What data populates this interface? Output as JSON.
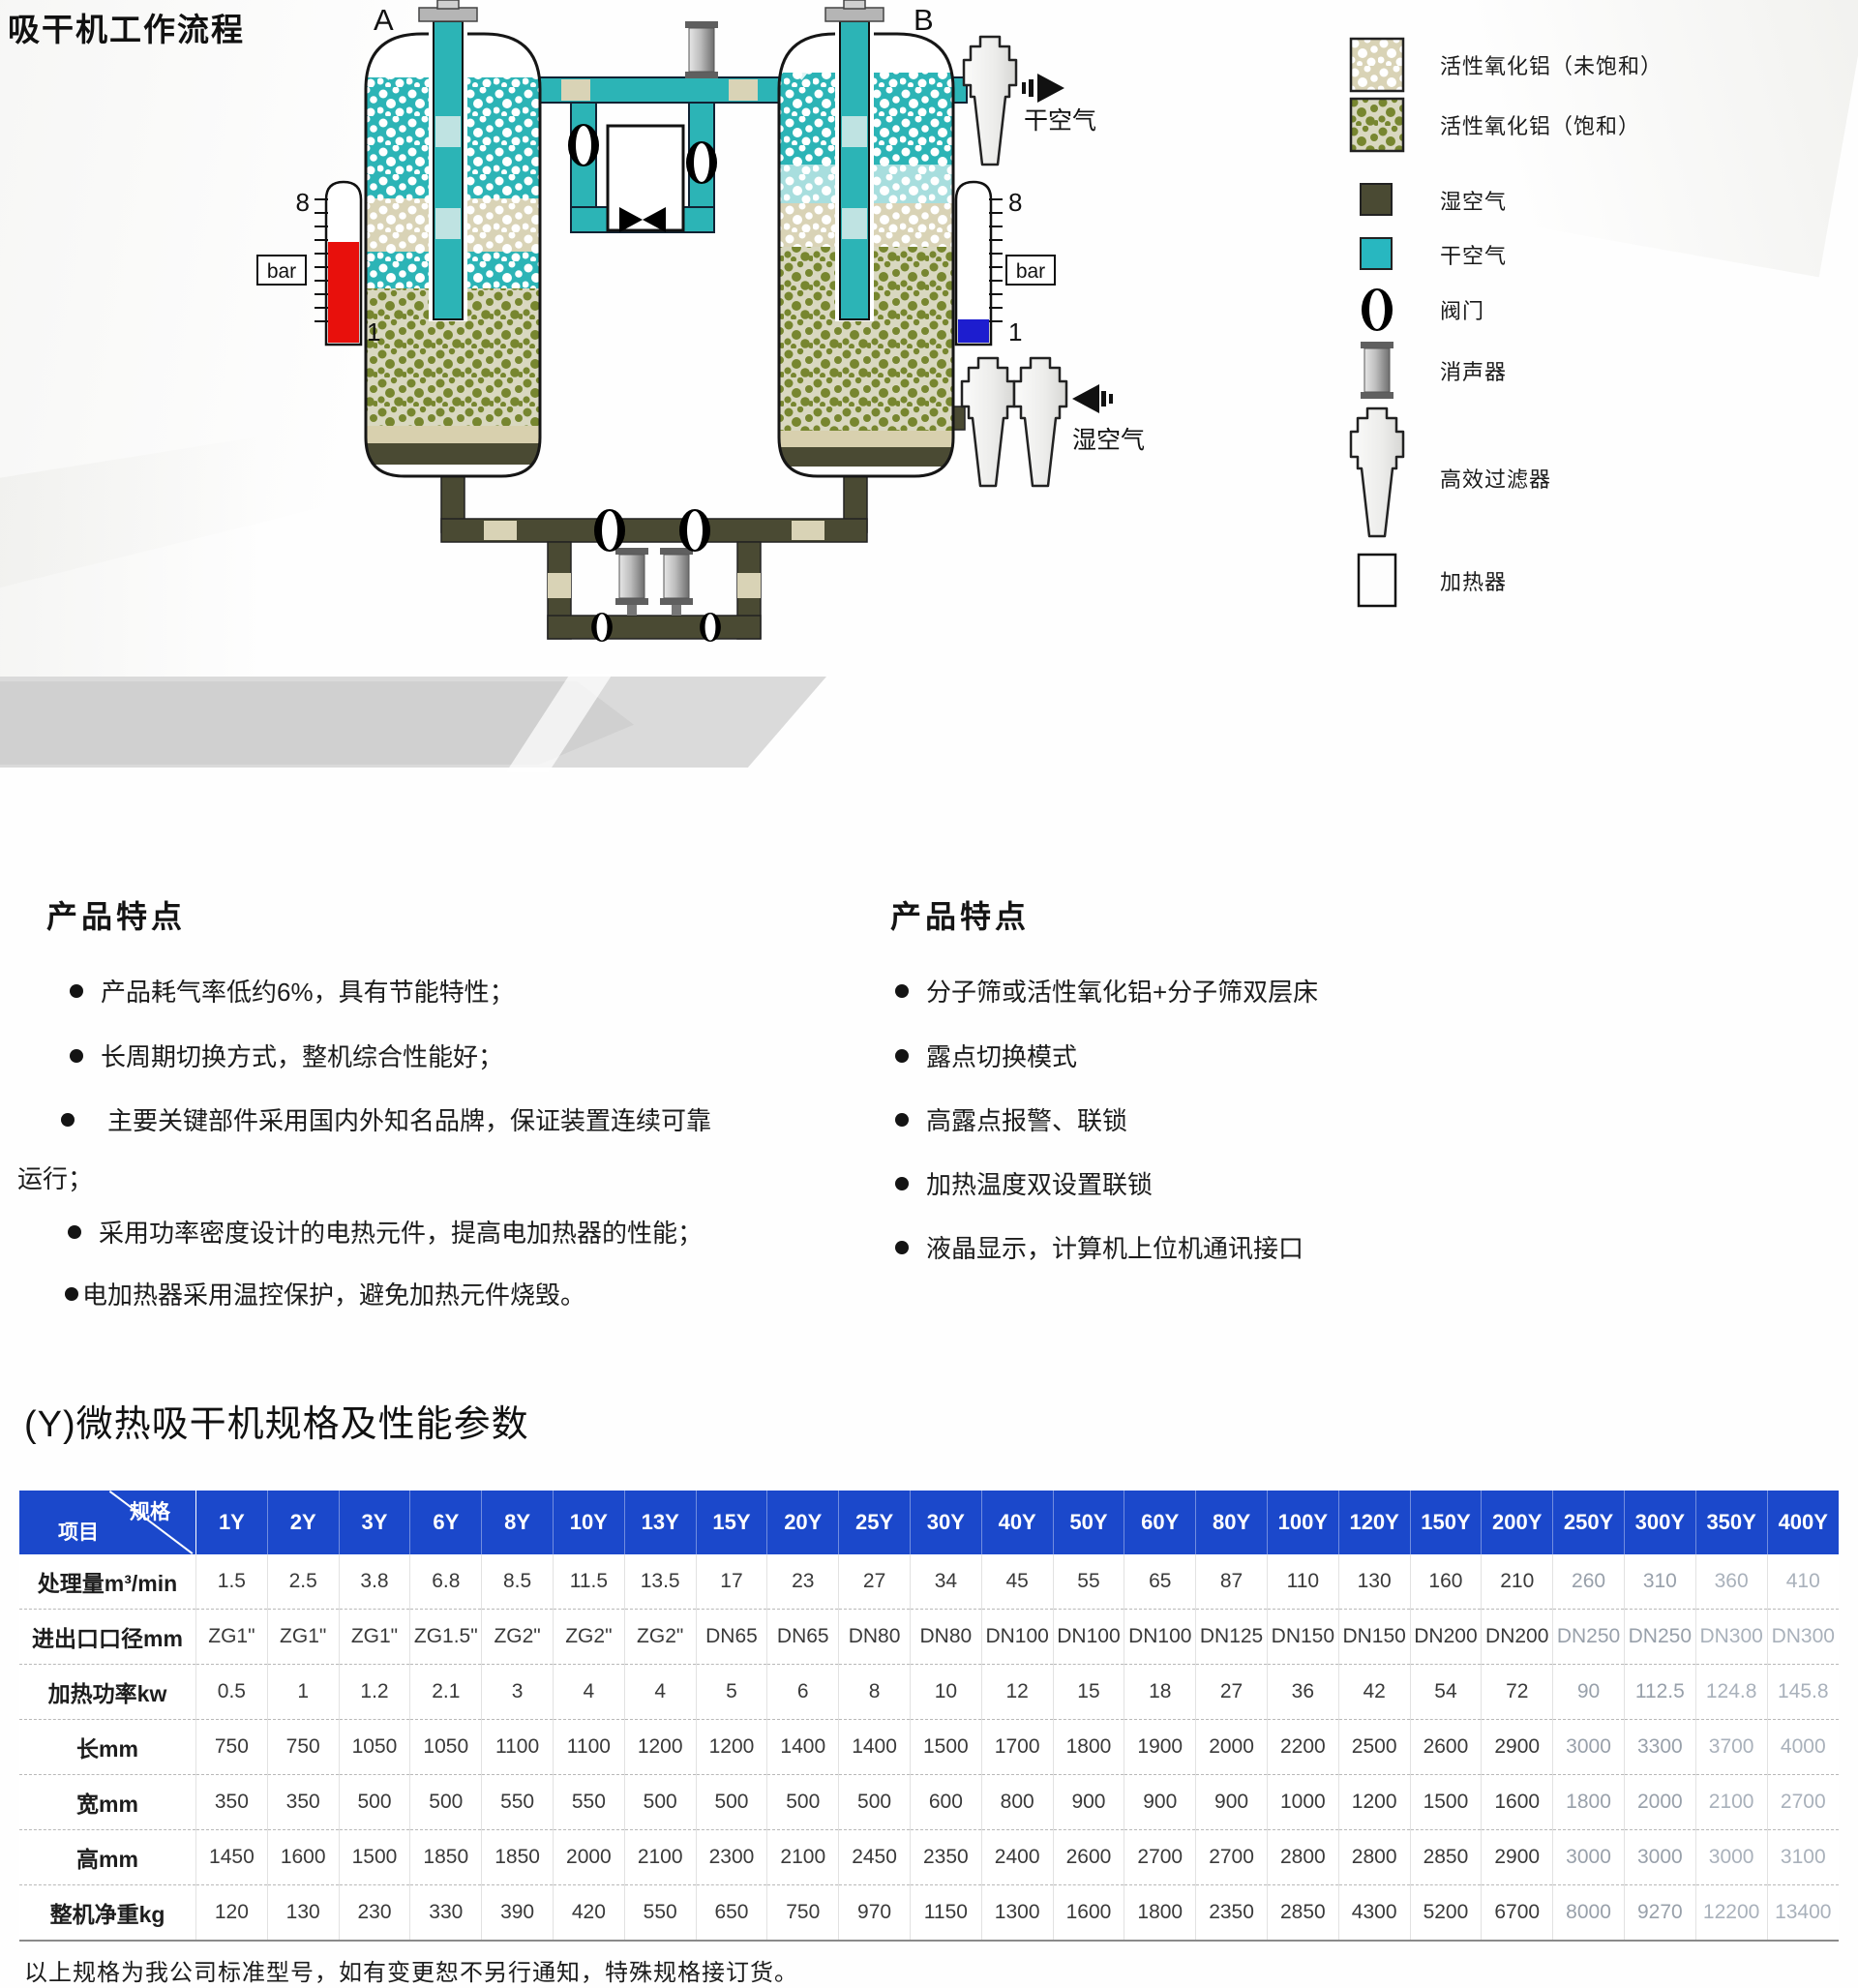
{
  "header": {
    "title": "吸干机工作流程"
  },
  "diagram": {
    "tower_a": "A",
    "tower_b": "B",
    "gauge_left": {
      "top": "8",
      "bottom": "1",
      "unit": "bar"
    },
    "gauge_right": {
      "top": "8",
      "bottom": "1",
      "unit": "bar"
    },
    "dry_air_label": "干空气",
    "wet_air_label": "湿空气"
  },
  "legend": {
    "items": [
      {
        "label": "活性氧化铝（未饱和）"
      },
      {
        "label": "活性氧化铝（饱和）"
      },
      {
        "label": "湿空气"
      },
      {
        "label": "干空气"
      },
      {
        "label": "阀门"
      },
      {
        "label": "消声器"
      },
      {
        "label": "高效过滤器"
      },
      {
        "label": "加热器"
      }
    ]
  },
  "features_left": {
    "heading": "产品特点",
    "items": [
      {
        "text": "产品耗气率低约6%，具有节能特性；"
      },
      {
        "text": "长周期切换方式，整机综合性能好；"
      },
      {
        "text": "主要关键部件采用国内外知名品牌，保证装置连续可靠"
      },
      {
        "text": "运行；"
      },
      {
        "text": "采用功率密度设计的电热元件，提高电加热器的性能；"
      },
      {
        "text": "电加热器采用温控保护，避免加热元件烧毁。"
      }
    ]
  },
  "features_right": {
    "heading": "产品特点",
    "items": [
      {
        "text": "分子筛或活性氧化铝+分子筛双层床"
      },
      {
        "text": "露点切换模式"
      },
      {
        "text": "高露点报警、联锁"
      },
      {
        "text": "加热温度双设置联锁"
      },
      {
        "text": "液晶显示，计算机上位机通讯接口"
      }
    ]
  },
  "spec_section": {
    "title": "(Y)微热吸干机规格及性能参数"
  },
  "table": {
    "corner_top": "规格",
    "corner_bottom": "项目",
    "columns": [
      "1Y",
      "2Y",
      "3Y",
      "6Y",
      "8Y",
      "10Y",
      "13Y",
      "15Y",
      "20Y",
      "25Y",
      "30Y",
      "40Y",
      "50Y",
      "60Y",
      "80Y",
      "100Y",
      "120Y",
      "150Y",
      "200Y",
      "250Y",
      "300Y",
      "350Y",
      "400Y"
    ],
    "rows": [
      {
        "label": "处理量m³/min",
        "values": [
          "1.5",
          "2.5",
          "3.8",
          "6.8",
          "8.5",
          "11.5",
          "13.5",
          "17",
          "23",
          "27",
          "34",
          "45",
          "55",
          "65",
          "87",
          "110",
          "130",
          "160",
          "210",
          "260",
          "310",
          "360",
          "410"
        ]
      },
      {
        "label": "进出口口径mm",
        "values": [
          "ZG1\"",
          "ZG1\"",
          "ZG1\"",
          "ZG1.5\"",
          "ZG2\"",
          "ZG2\"",
          "ZG2\"",
          "DN65",
          "DN65",
          "DN80",
          "DN80",
          "DN100",
          "DN100",
          "DN100",
          "DN125",
          "DN150",
          "DN150",
          "DN200",
          "DN200",
          "DN250",
          "DN250",
          "DN300",
          "DN300"
        ]
      },
      {
        "label": "加热功率kw",
        "values": [
          "0.5",
          "1",
          "1.2",
          "2.1",
          "3",
          "4",
          "4",
          "5",
          "6",
          "8",
          "10",
          "12",
          "15",
          "18",
          "27",
          "36",
          "42",
          "54",
          "72",
          "90",
          "112.5",
          "124.8",
          "145.8"
        ]
      },
      {
        "label": "长mm",
        "values": [
          "750",
          "750",
          "1050",
          "1050",
          "1100",
          "1100",
          "1200",
          "1200",
          "1400",
          "1400",
          "1500",
          "1700",
          "1800",
          "1900",
          "2000",
          "2200",
          "2500",
          "2600",
          "2900",
          "3000",
          "3300",
          "3700",
          "4000"
        ]
      },
      {
        "label": "宽mm",
        "values": [
          "350",
          "350",
          "500",
          "500",
          "550",
          "550",
          "500",
          "500",
          "500",
          "500",
          "600",
          "800",
          "900",
          "900",
          "900",
          "1000",
          "1200",
          "1500",
          "1600",
          "1800",
          "2000",
          "2100",
          "2700"
        ]
      },
      {
        "label": "高mm",
        "values": [
          "1450",
          "1600",
          "1500",
          "1850",
          "1850",
          "2000",
          "2100",
          "2300",
          "2100",
          "2450",
          "2350",
          "2400",
          "2600",
          "2700",
          "2700",
          "2800",
          "2800",
          "2850",
          "2900",
          "3000",
          "3000",
          "3000",
          "3100"
        ]
      },
      {
        "label": "整机净重kg",
        "values": [
          "120",
          "130",
          "230",
          "330",
          "390",
          "420",
          "550",
          "650",
          "750",
          "970",
          "1150",
          "1300",
          "1600",
          "1800",
          "2350",
          "2850",
          "4300",
          "5200",
          "6700",
          "8000",
          "9270",
          "12200",
          "13400"
        ]
      }
    ]
  },
  "footnote": "以上规格为我公司标准型号，如有变更恕不另行通知，特殊规格接订货。",
  "colors": {
    "header_blue": "#1b48cb",
    "dry_air_teal": "#2cb4b6",
    "wet_air_olive": "#4a4a33",
    "gauge_red": "#e8100c",
    "gauge_blue": "#1d1dcf"
  }
}
